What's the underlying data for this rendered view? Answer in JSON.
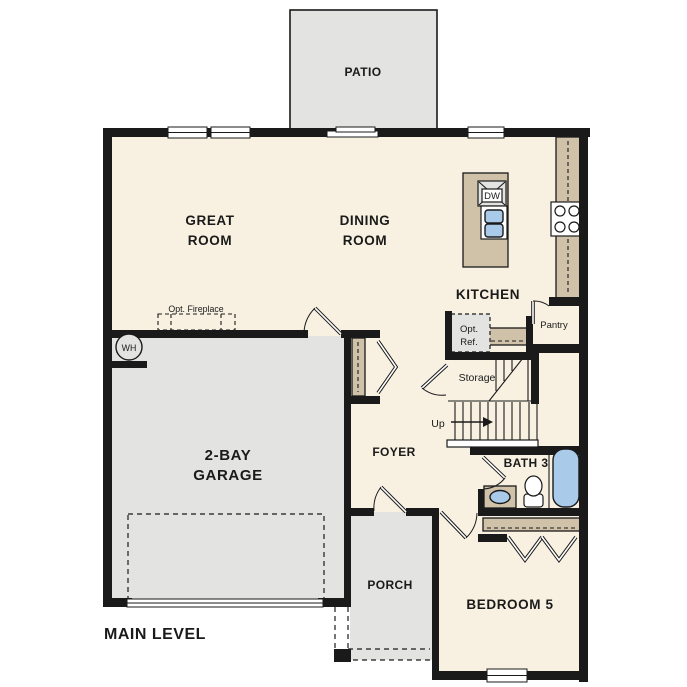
{
  "plan": {
    "title": "MAIN LEVEL"
  },
  "rooms": {
    "patio": "PATIO",
    "great_room_line1": "GREAT",
    "great_room_line2": "ROOM",
    "dining_room_line1": "DINING",
    "dining_room_line2": "ROOM",
    "kitchen": "KITCHEN",
    "pantry": "Pantry",
    "storage": "Storage",
    "foyer": "FOYER",
    "garage_line1": "2-BAY",
    "garage_line2": "GARAGE",
    "bath3": "BATH 3",
    "porch": "PORCH",
    "bedroom5": "BEDROOM 5"
  },
  "annotations": {
    "opt_fireplace": "Opt. Fireplace",
    "opt_ref_line1": "Opt.",
    "opt_ref_line2": "Ref.",
    "water_heater": "WH",
    "dishwasher": "DW",
    "stairs_up": "Up"
  },
  "colors": {
    "wall": "#1a1a1a",
    "floor": "#f8f1e2",
    "slab": "#e3e3e1",
    "counter": "#cfc2a9",
    "fixture": "#a9cae8"
  }
}
